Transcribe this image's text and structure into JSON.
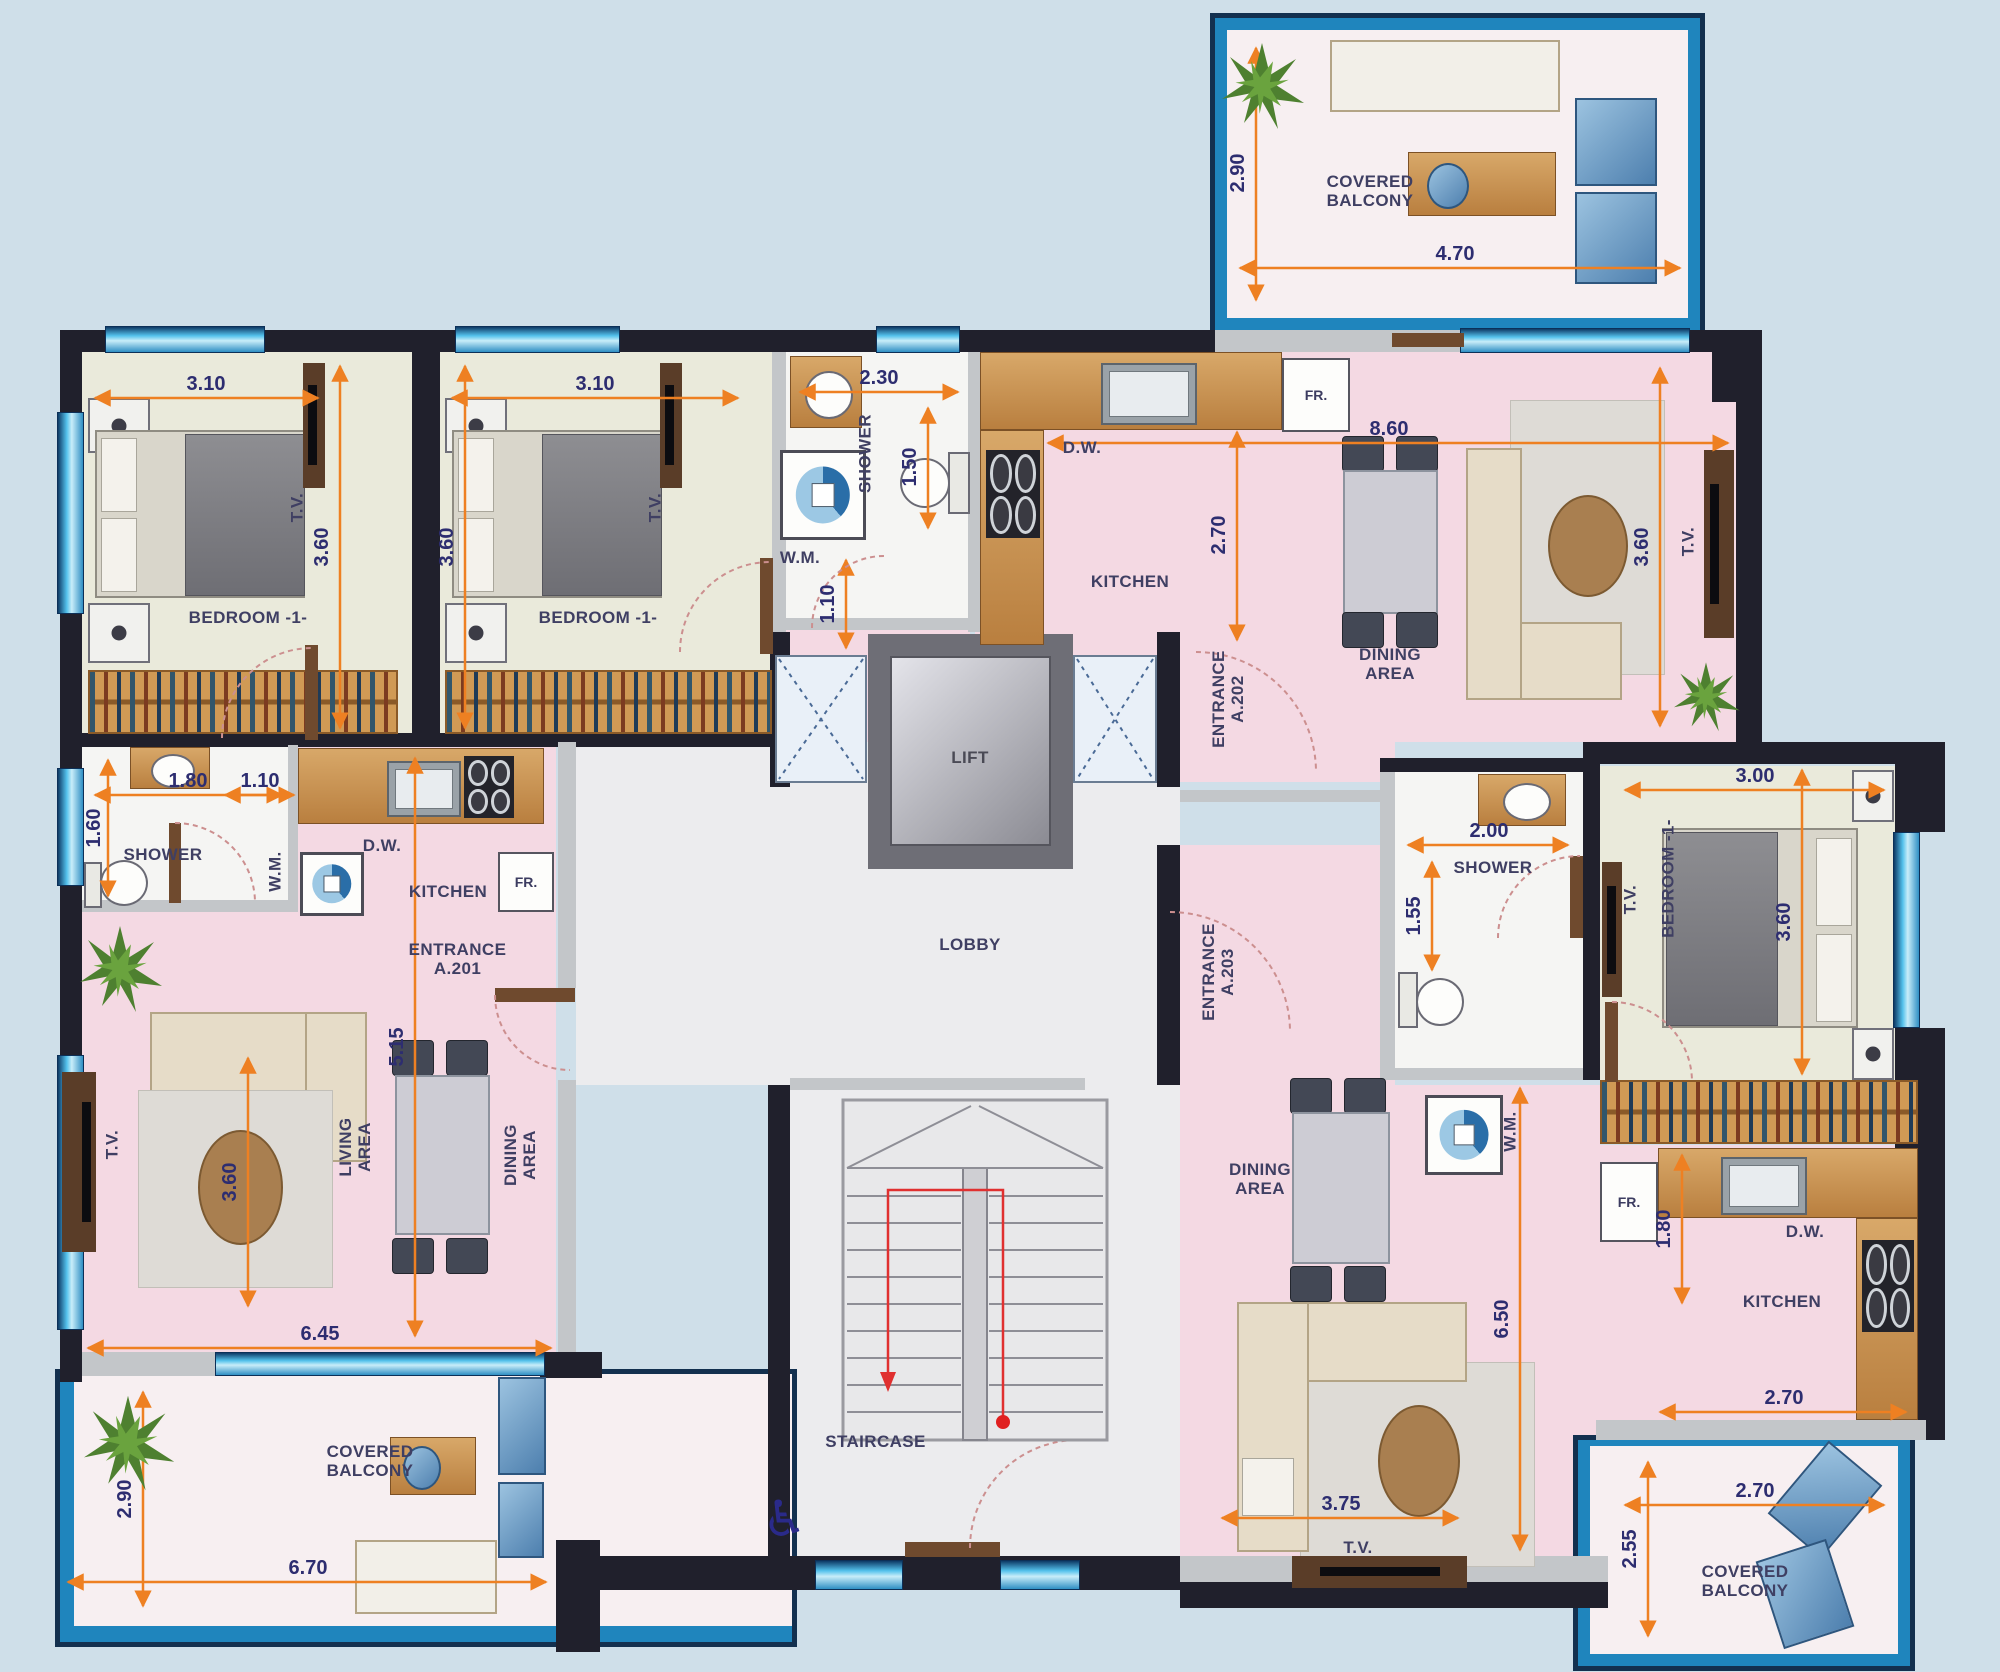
{
  "title": "Apartment floor plan – level with units A.201, A.202, A.203",
  "colors": {
    "background": "#cfdfe9",
    "wall": "#20202c",
    "floor_pink": "#f4d9e3",
    "floor_bedroom": "#eaeadb",
    "dimension_orange": "#ee8022",
    "dimension_text": "#2d2d70",
    "label_text": "#3f3f63",
    "window_blue": "#54c2ec",
    "balcony_border": "#1f85bd"
  },
  "labels": {
    "covered_balcony": "COVERED\nBALCONY",
    "bedroom": "BEDROOM -1-",
    "shower": "SHOWER",
    "kitchen": "KITCHEN",
    "dining_area": "DINING\nAREA",
    "living_area": "LIVING\nAREA",
    "lift": "LIFT",
    "lobby": "LOBBY",
    "staircase": "STAIRCASE",
    "entrance_a201": "ENTRANCE\nA.201",
    "entrance_a202": "ENTRANCE\nA.202",
    "entrance_a203": "ENTRANCE\nA.203",
    "wm": "W.M.",
    "dw": "D.W.",
    "fr": "FR.",
    "tv": "T.V."
  },
  "dims": {
    "balcony_tr_v": "2.90",
    "balcony_tr_h": "4.70",
    "bed1_w": "3.10",
    "bed1_h": "3.60",
    "bed2_w": "3.10",
    "bed2_h": "3.60",
    "shower_a202_w": "2.30",
    "shower_a202_h": "1.50",
    "hall_a202": "1.10",
    "kitchen_a202_d": "2.70",
    "a202_w": "8.60",
    "living_a202_h": "3.60",
    "shower_a201_w": "1.80",
    "shower_a201_h": "1.60",
    "hall_a201": "1.10",
    "a201_d": "5.15",
    "living_a201_h": "3.60",
    "living_a201_w": "6.45",
    "balcony_bl_v": "2.90",
    "balcony_bl_w": "6.70",
    "shower_a203_w": "2.00",
    "shower_a203_h": "1.55",
    "bed3_w": "3.00",
    "bed3_h": "3.60",
    "a203_d": "6.50",
    "kitchen_a203_d": "1.80",
    "kitchen_a203_w": "2.70",
    "living_a203_w": "3.75",
    "balcony_br_w": "2.70",
    "balcony_br_h": "2.55"
  },
  "icons": {
    "wheelchair": "♿"
  }
}
